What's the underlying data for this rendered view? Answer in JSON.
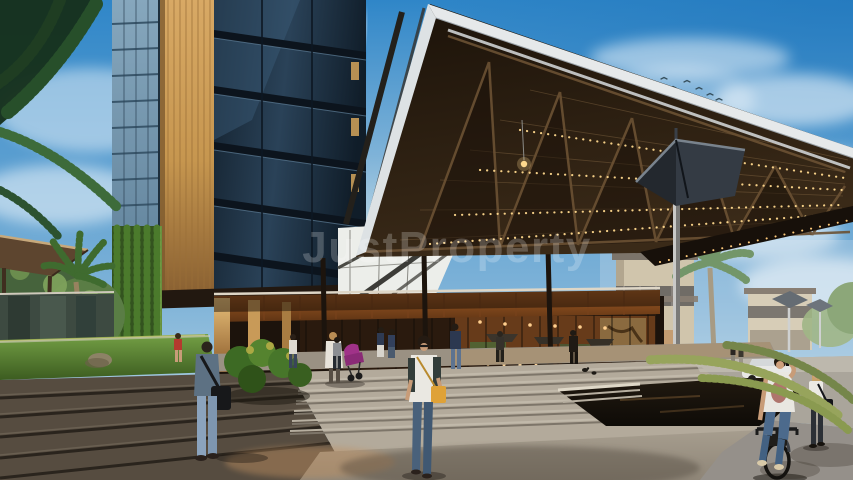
{
  "scene": {
    "watermark": {
      "text": "JustProperty"
    },
    "palette": {
      "sky_top": "#2f86c8",
      "sky_horizon": "#c8dfe9",
      "cloud_white": "#ffffff",
      "tower_glass_dark": "#14222f",
      "tower_glass_light": "#86a7bd",
      "wood_warm": "#d8a965",
      "wood_deep": "#8a6132",
      "canopy_brown": "#2a1c10",
      "canopy_lights": "#ffd98e",
      "steps_light": "#b3aa9b",
      "steps_dark": "#564c40",
      "grass_green": "#527a33",
      "palm_dark_green": "#1f3d22",
      "water_dark": "#17130e",
      "stroller_magenta": "#a03288",
      "bag_yellow": "#dfa238",
      "watermark_white": "#ffffff"
    }
  }
}
